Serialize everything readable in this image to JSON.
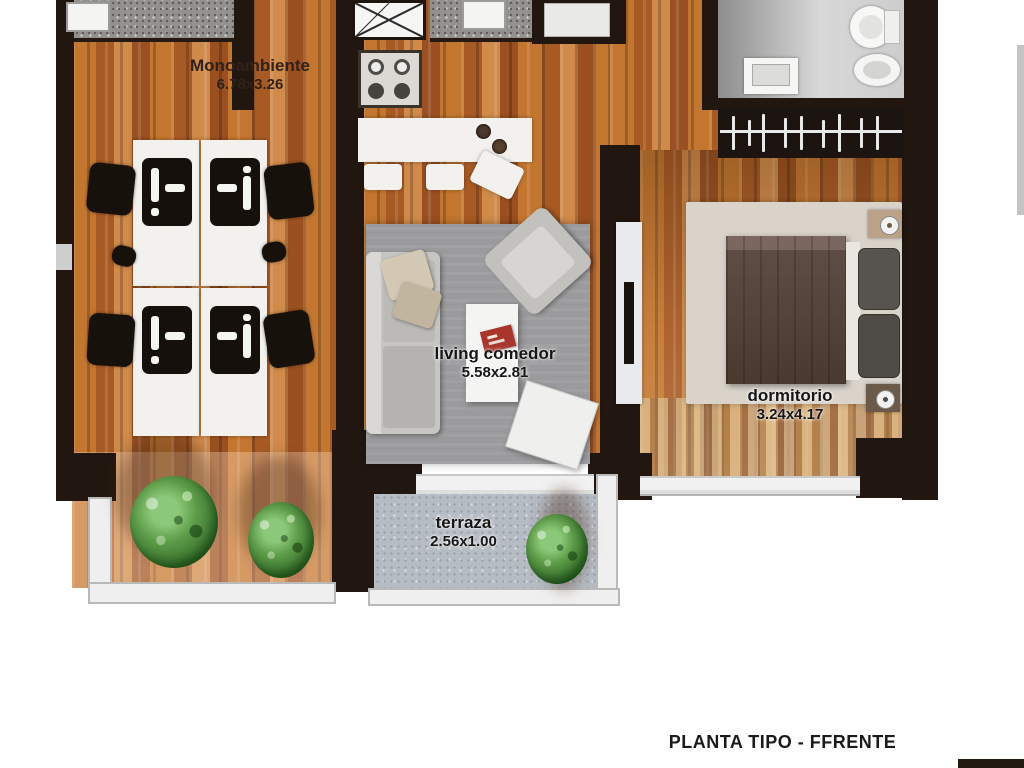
{
  "plan_title": "PLANTA TIPO - FFRENTE",
  "rooms": [
    {
      "id": "monoambiente",
      "label": "Monoambiente",
      "dimensions": "6.78x3.26"
    },
    {
      "id": "living_comedor",
      "label": "living comedor",
      "dimensions": "5.58x2.81"
    },
    {
      "id": "dormitorio",
      "label": "dormitorio",
      "dimensions": "3.24x4.17"
    },
    {
      "id": "terraza",
      "label": "terraza",
      "dimensions": "2.56x1.00"
    }
  ],
  "colors": {
    "wall": "#221710",
    "wood_floor": "#b96b31",
    "terrace_floor": "#b6bcc4",
    "counter_speckle": "#93918d",
    "label_text": "#241a10",
    "accent_red_object": "#a8362c",
    "plant_green": "#5d9c49",
    "background": "#ffffff"
  }
}
